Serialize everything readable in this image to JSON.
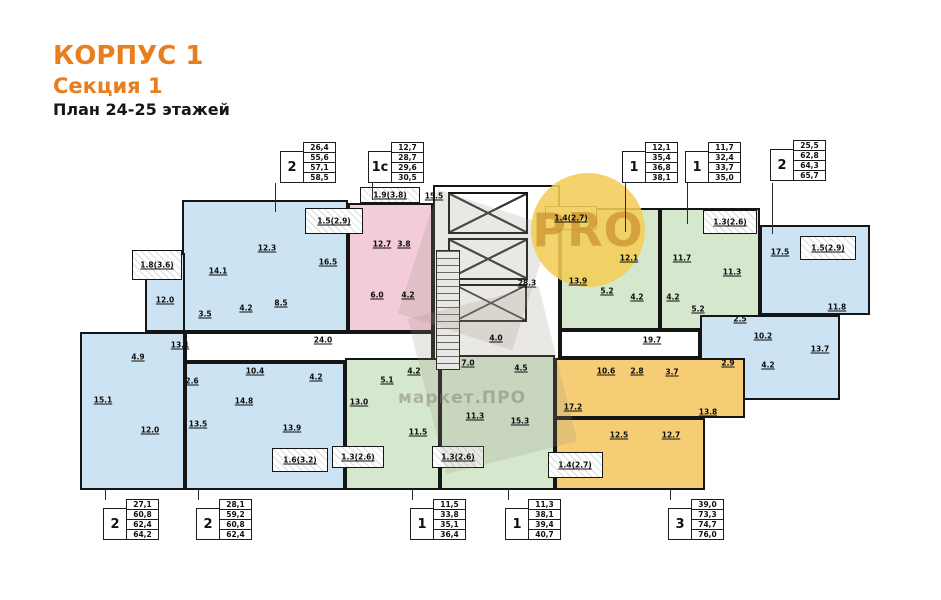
{
  "header": {
    "building": "КОРПУС 1",
    "section": "Секция 1",
    "plan_title": "План 24-25 этажей"
  },
  "watermark": {
    "circle_text": "PRO",
    "brand_text": "маркет.ПРО"
  },
  "colors": {
    "accent": "#E87E1E",
    "blue": "#CBE3F2",
    "pink": "#F3CBD9",
    "green": "#D5E8CE",
    "orange": "#F6CC74",
    "white": "#FFFFFF",
    "wall": "#151515"
  },
  "legend_tables": [
    {
      "type": "2",
      "values": [
        "26,4",
        "55,6",
        "57,1",
        "58,5"
      ],
      "x": 280,
      "y": 143
    },
    {
      "type": "1с",
      "values": [
        "12,7",
        "28,7",
        "29,6",
        "30,5"
      ],
      "x": 368,
      "y": 143
    },
    {
      "type": "1",
      "values": [
        "12,1",
        "35,4",
        "36,8",
        "38,1"
      ],
      "x": 622,
      "y": 143
    },
    {
      "type": "1",
      "values": [
        "11,7",
        "32,4",
        "33,7",
        "35,0"
      ],
      "x": 685,
      "y": 143
    },
    {
      "type": "2",
      "values": [
        "25,5",
        "62,8",
        "64,3",
        "65,7"
      ],
      "x": 770,
      "y": 141
    },
    {
      "type": "2",
      "values": [
        "27,1",
        "60,8",
        "62,4",
        "64,2"
      ],
      "x": 103,
      "y": 500
    },
    {
      "type": "2",
      "values": [
        "28,1",
        "59,2",
        "60,8",
        "62,4"
      ],
      "x": 196,
      "y": 500
    },
    {
      "type": "1",
      "values": [
        "11,5",
        "33,8",
        "35,1",
        "36,4"
      ],
      "x": 410,
      "y": 500
    },
    {
      "type": "1",
      "values": [
        "11,3",
        "38,1",
        "39,4",
        "40,7"
      ],
      "x": 505,
      "y": 500
    },
    {
      "type": "3",
      "values": [
        "39,0",
        "73,3",
        "74,7",
        "76,0"
      ],
      "x": 668,
      "y": 500
    }
  ],
  "plan": {
    "regions": [
      {
        "name": "core-block",
        "fill": "white",
        "x": 433,
        "y": 185,
        "w": 127,
        "h": 235
      },
      {
        "name": "corridor-left",
        "fill": "white",
        "x": 185,
        "y": 332,
        "w": 248,
        "h": 30
      },
      {
        "name": "corridor-right",
        "fill": "white",
        "x": 560,
        "y": 330,
        "w": 140,
        "h": 28
      },
      {
        "name": "apt-2-topleft-main",
        "fill": "blue",
        "x": 182,
        "y": 200,
        "w": 166,
        "h": 132
      },
      {
        "name": "apt-2-topleft-kitchen",
        "fill": "blue",
        "x": 145,
        "y": 253,
        "w": 40,
        "h": 79
      },
      {
        "name": "apt-2-left",
        "fill": "blue",
        "x": 80,
        "y": 332,
        "w": 105,
        "h": 158
      },
      {
        "name": "apt-2-bottomleft",
        "fill": "blue",
        "x": 185,
        "y": 362,
        "w": 160,
        "h": 128
      },
      {
        "name": "apt-1c-studio",
        "fill": "pink",
        "x": 348,
        "y": 203,
        "w": 85,
        "h": 129
      },
      {
        "name": "apt-1-green-west",
        "fill": "green",
        "x": 560,
        "y": 208,
        "w": 100,
        "h": 122
      },
      {
        "name": "apt-1-green-east",
        "fill": "green",
        "x": 660,
        "y": 208,
        "w": 100,
        "h": 122
      },
      {
        "name": "apt-2-topright-upper",
        "fill": "blue",
        "x": 760,
        "y": 225,
        "w": 110,
        "h": 90
      },
      {
        "name": "apt-2-topright-lower",
        "fill": "blue",
        "x": 700,
        "y": 315,
        "w": 140,
        "h": 85
      },
      {
        "name": "apt-1-bottom-west",
        "fill": "green",
        "x": 345,
        "y": 358,
        "w": 95,
        "h": 132
      },
      {
        "name": "apt-1-bottom-east",
        "fill": "green",
        "x": 440,
        "y": 355,
        "w": 115,
        "h": 135
      },
      {
        "name": "apt-3-orange-upper",
        "fill": "orange",
        "x": 555,
        "y": 358,
        "w": 190,
        "h": 60
      },
      {
        "name": "apt-3-orange-lower",
        "fill": "orange",
        "x": 555,
        "y": 418,
        "w": 150,
        "h": 72
      },
      {
        "name": "balcony",
        "fill": "balcony",
        "x": 132,
        "y": 250,
        "w": 50,
        "h": 30
      },
      {
        "name": "balcony",
        "fill": "balcony",
        "x": 305,
        "y": 208,
        "w": 58,
        "h": 26
      },
      {
        "name": "balcony",
        "fill": "balcony",
        "x": 360,
        "y": 187,
        "w": 60,
        "h": 16
      },
      {
        "name": "balcony",
        "fill": "balcony",
        "x": 545,
        "y": 206,
        "w": 52,
        "h": 24
      },
      {
        "name": "balcony",
        "fill": "balcony",
        "x": 703,
        "y": 210,
        "w": 54,
        "h": 24
      },
      {
        "name": "balcony",
        "fill": "balcony",
        "x": 800,
        "y": 236,
        "w": 56,
        "h": 24
      },
      {
        "name": "balcony",
        "fill": "balcony",
        "x": 272,
        "y": 448,
        "w": 56,
        "h": 24
      },
      {
        "name": "balcony",
        "fill": "balcony",
        "x": 332,
        "y": 446,
        "w": 52,
        "h": 22
      },
      {
        "name": "balcony",
        "fill": "balcony",
        "x": 432,
        "y": 446,
        "w": 52,
        "h": 22
      },
      {
        "name": "balcony",
        "fill": "balcony",
        "x": 548,
        "y": 452,
        "w": 55,
        "h": 26
      }
    ],
    "elevators": [
      {
        "x": 448,
        "y": 192,
        "w": 80,
        "h": 42
      },
      {
        "x": 448,
        "y": 238,
        "w": 80,
        "h": 42
      },
      {
        "x": 455,
        "y": 284,
        "w": 72,
        "h": 38
      }
    ],
    "stairs": {
      "x": 436,
      "y": 250,
      "w": 24,
      "h": 120
    },
    "labels": [
      {
        "x": 267,
        "y": 248,
        "t": "12.3"
      },
      {
        "x": 218,
        "y": 271,
        "t": "14.1"
      },
      {
        "x": 328,
        "y": 262,
        "t": "16.5"
      },
      {
        "x": 165,
        "y": 300,
        "t": "12.0"
      },
      {
        "x": 205,
        "y": 314,
        "t": "3.5"
      },
      {
        "x": 246,
        "y": 308,
        "t": "4.2"
      },
      {
        "x": 281,
        "y": 303,
        "t": "8.5"
      },
      {
        "x": 180,
        "y": 345,
        "t": "13.1"
      },
      {
        "x": 138,
        "y": 357,
        "t": "4.9"
      },
      {
        "x": 103,
        "y": 400,
        "t": "15.1"
      },
      {
        "x": 150,
        "y": 430,
        "t": "12.0"
      },
      {
        "x": 192,
        "y": 381,
        "t": "2.6"
      },
      {
        "x": 255,
        "y": 371,
        "t": "10.4"
      },
      {
        "x": 198,
        "y": 424,
        "t": "13.5"
      },
      {
        "x": 244,
        "y": 401,
        "t": "14.8"
      },
      {
        "x": 292,
        "y": 428,
        "t": "13.9"
      },
      {
        "x": 316,
        "y": 377,
        "t": "4.2"
      },
      {
        "x": 382,
        "y": 244,
        "t": "12.7"
      },
      {
        "x": 404,
        "y": 244,
        "t": "3.8"
      },
      {
        "x": 377,
        "y": 295,
        "t": "6.0"
      },
      {
        "x": 408,
        "y": 295,
        "t": "4.2"
      },
      {
        "x": 434,
        "y": 196,
        "t": "15.5"
      },
      {
        "x": 527,
        "y": 283,
        "t": "28.3"
      },
      {
        "x": 496,
        "y": 338,
        "t": "4.0"
      },
      {
        "x": 323,
        "y": 340,
        "t": "24.0"
      },
      {
        "x": 652,
        "y": 340,
        "t": "19.7"
      },
      {
        "x": 629,
        "y": 258,
        "t": "12.1"
      },
      {
        "x": 578,
        "y": 281,
        "t": "13.9"
      },
      {
        "x": 607,
        "y": 291,
        "t": "5.2"
      },
      {
        "x": 637,
        "y": 297,
        "t": "4.2"
      },
      {
        "x": 682,
        "y": 258,
        "t": "11.7"
      },
      {
        "x": 732,
        "y": 272,
        "t": "11.3"
      },
      {
        "x": 673,
        "y": 297,
        "t": "4.2"
      },
      {
        "x": 698,
        "y": 309,
        "t": "5.2"
      },
      {
        "x": 780,
        "y": 252,
        "t": "17.5"
      },
      {
        "x": 837,
        "y": 307,
        "t": "11.8"
      },
      {
        "x": 740,
        "y": 319,
        "t": "2.5"
      },
      {
        "x": 763,
        "y": 336,
        "t": "10.2"
      },
      {
        "x": 820,
        "y": 349,
        "t": "13.7"
      },
      {
        "x": 728,
        "y": 363,
        "t": "2.9"
      },
      {
        "x": 768,
        "y": 365,
        "t": "4.2"
      },
      {
        "x": 606,
        "y": 371,
        "t": "10.6"
      },
      {
        "x": 637,
        "y": 371,
        "t": "2.8"
      },
      {
        "x": 672,
        "y": 372,
        "t": "3.7"
      },
      {
        "x": 573,
        "y": 407,
        "t": "17.2"
      },
      {
        "x": 708,
        "y": 412,
        "t": "13.8"
      },
      {
        "x": 619,
        "y": 435,
        "t": "12.5"
      },
      {
        "x": 671,
        "y": 435,
        "t": "12.7"
      },
      {
        "x": 359,
        "y": 402,
        "t": "13.0"
      },
      {
        "x": 387,
        "y": 380,
        "t": "5.1"
      },
      {
        "x": 414,
        "y": 371,
        "t": "4.2"
      },
      {
        "x": 418,
        "y": 432,
        "t": "11.5"
      },
      {
        "x": 468,
        "y": 363,
        "t": "7.0"
      },
      {
        "x": 521,
        "y": 368,
        "t": "4.5"
      },
      {
        "x": 475,
        "y": 416,
        "t": "11.3"
      },
      {
        "x": 520,
        "y": 421,
        "t": "15.3"
      },
      {
        "x": 157,
        "y": 265,
        "t": "1.8(3.6)"
      },
      {
        "x": 334,
        "y": 221,
        "t": "1.5(2.9)"
      },
      {
        "x": 390,
        "y": 195,
        "t": "1.9(3.8)"
      },
      {
        "x": 571,
        "y": 218,
        "t": "1.4(2.7)"
      },
      {
        "x": 730,
        "y": 222,
        "t": "1.3(2.6)"
      },
      {
        "x": 828,
        "y": 248,
        "t": "1.5(2.9)"
      },
      {
        "x": 300,
        "y": 460,
        "t": "1.6(3.2)"
      },
      {
        "x": 358,
        "y": 457,
        "t": "1.3(2.6)"
      },
      {
        "x": 458,
        "y": 457,
        "t": "1.3(2.6)"
      },
      {
        "x": 575,
        "y": 465,
        "t": "1.4(2.7)"
      }
    ],
    "leaders": [
      {
        "x": 275,
        "y1": 183,
        "y2": 212
      },
      {
        "x": 372,
        "y1": 183,
        "y2": 200
      },
      {
        "x": 625,
        "y1": 183,
        "y2": 232
      },
      {
        "x": 687,
        "y1": 183,
        "y2": 224
      },
      {
        "x": 772,
        "y1": 183,
        "y2": 234
      },
      {
        "x": 105,
        "y1": 490,
        "y2": 501
      },
      {
        "x": 198,
        "y1": 490,
        "y2": 501
      },
      {
        "x": 412,
        "y1": 490,
        "y2": 501
      },
      {
        "x": 508,
        "y1": 490,
        "y2": 501
      },
      {
        "x": 670,
        "y1": 490,
        "y2": 501
      }
    ]
  }
}
